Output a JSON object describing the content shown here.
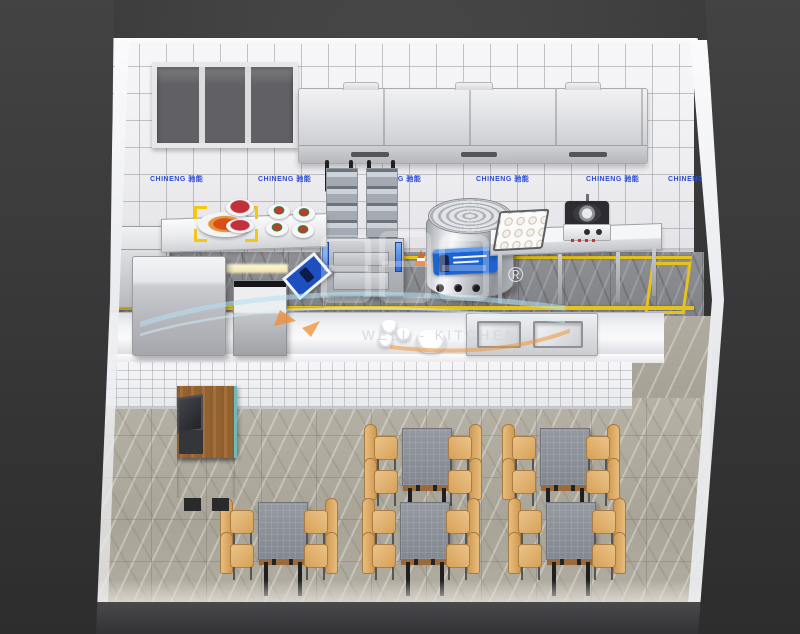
{
  "scene": {
    "description": "3D isometric cutaway render of a commercial fast-food kitchen with cooking line, serving pass counter and dining area",
    "background_color": "#3a3a3a",
    "wall_tile_color": "#f4f4f6",
    "kitchen_floor_color": "#8b8b8f",
    "dining_floor_color": "#b2ada1",
    "floor_marking_color": "#e5c31c"
  },
  "wall_labels": {
    "text": "CHINENG 驰能",
    "color": "#2b4bd8"
  },
  "watermark": {
    "brand": "WELL - KITCHEN",
    "registered_mark": "®",
    "swoosh_color": "#b5e0f2",
    "accent_color": "#f0953c"
  }
}
